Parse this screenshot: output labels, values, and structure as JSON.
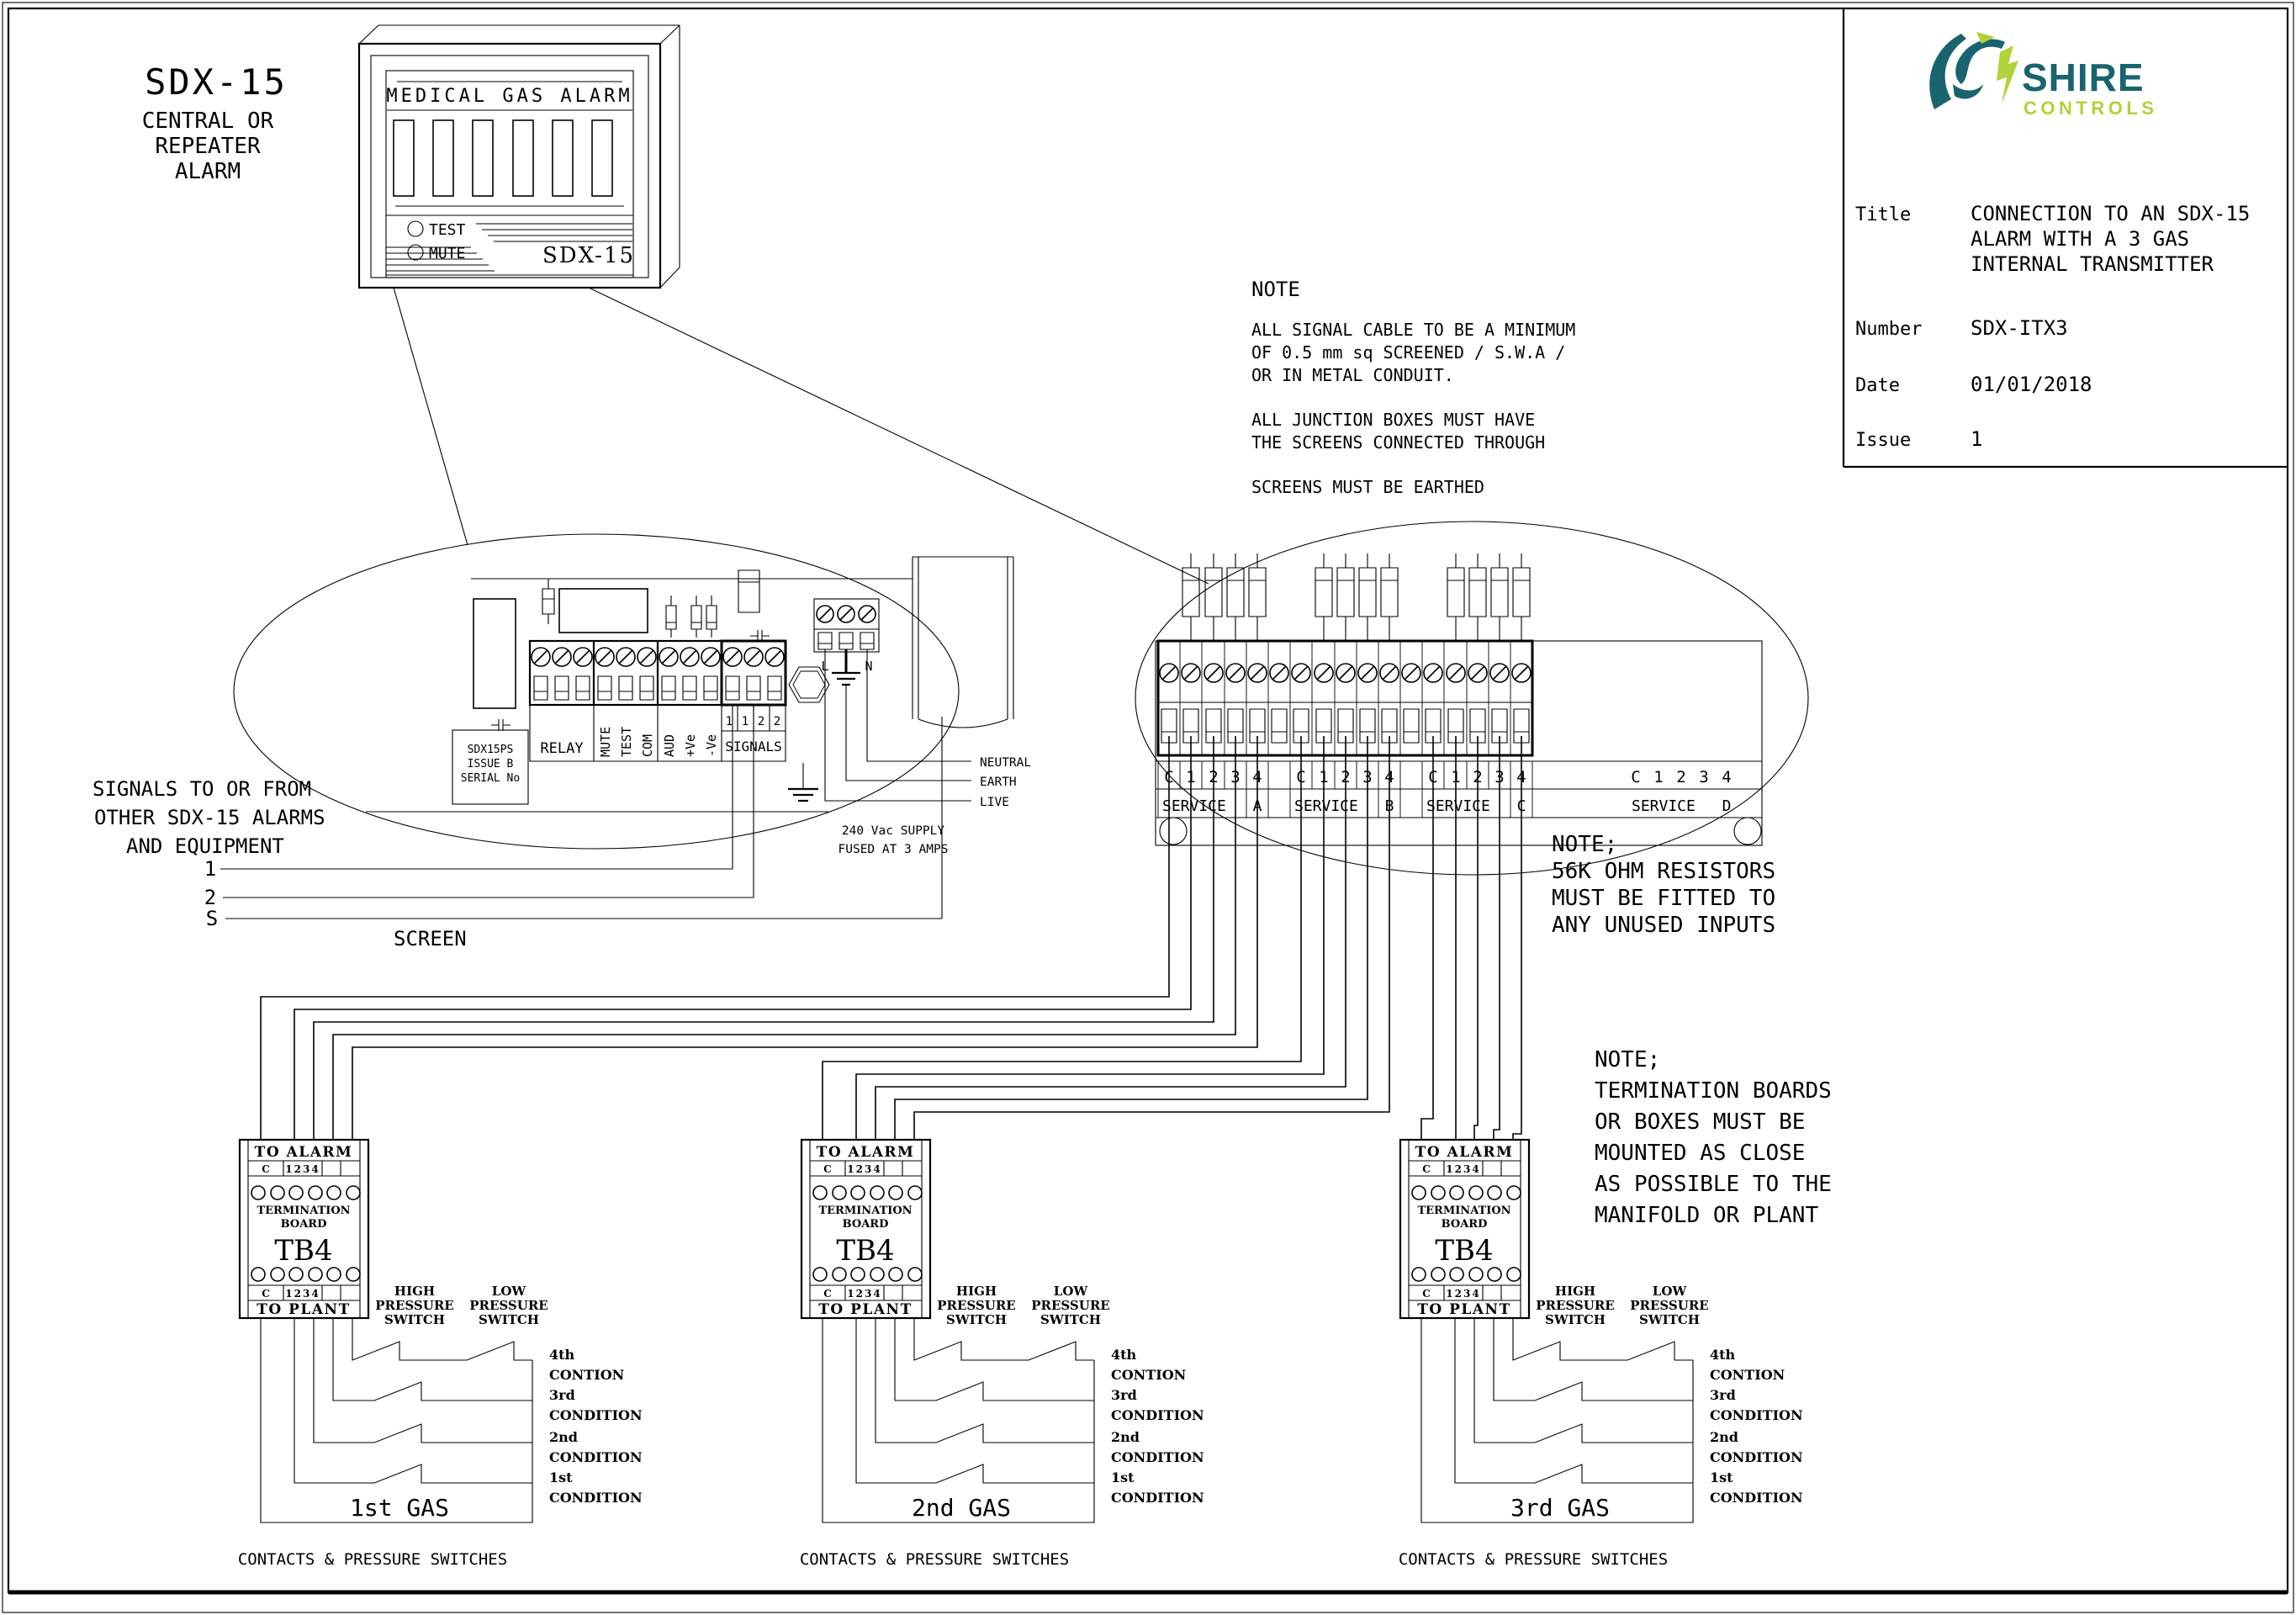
{
  "colors": {
    "ink": "#000000",
    "logo_teal": "#19646f",
    "logo_green": "#b0d23a"
  },
  "heading": {
    "model": "SDX-15",
    "lines": [
      "CENTRAL OR",
      "REPEATER",
      "ALARM"
    ]
  },
  "alarm_panel": {
    "title": "MEDICAL GAS ALARM",
    "test": "TEST",
    "mute": "MUTE",
    "model": "SDX-15"
  },
  "title_block": {
    "brand": [
      "SHIRE",
      "CONTROLS"
    ],
    "title_label": "Title",
    "title_lines": [
      "CONNECTION TO AN SDX-15",
      "ALARM WITH A 3 GAS",
      "INTERNAL TRANSMITTER"
    ],
    "number_label": "Number",
    "number": "SDX-ITX3",
    "date_label": "Date",
    "date": "01/01/2018",
    "issue_label": "Issue",
    "issue": "1"
  },
  "cable_note": {
    "heading": "NOTE",
    "lines": [
      "ALL SIGNAL CABLE TO BE A MINIMUM",
      "OF 0.5 mm sq SCREENED / S.W.A /",
      "OR IN METAL CONDUIT.",
      "ALL JUNCTION BOXES MUST HAVE",
      "THE SCREENS CONNECTED THROUGH",
      "SCREENS MUST BE EARTHED"
    ]
  },
  "left_board": {
    "psu": [
      "SDX15PS",
      "ISSUE B",
      "SERIAL No"
    ],
    "relay": "RELAY",
    "vertical_labels": [
      "MUTE",
      "TEST",
      "COM",
      "AUD",
      "+Ve",
      "-Ve"
    ],
    "signal_cells": [
      "1",
      "1",
      "2",
      "2"
    ],
    "signals": "SIGNALS",
    "live": "L",
    "neutral": "N",
    "wire_labels": [
      "NEUTRAL",
      "EARTH",
      "LIVE"
    ],
    "supply": [
      "240 Vac SUPPLY",
      "FUSED AT 3 AMPS"
    ]
  },
  "signals_note": {
    "lines": [
      "SIGNALS TO OR FROM",
      "OTHER SDX-15 ALARMS",
      "AND EQUIPMENT"
    ],
    "wires": [
      "1",
      "2",
      "S"
    ],
    "screen": "SCREEN"
  },
  "right_board": {
    "services": [
      {
        "cells": [
          "C",
          "1",
          "2",
          "3",
          "4"
        ],
        "name": "SERVICE",
        "letter": "A"
      },
      {
        "cells": [
          "C",
          "1",
          "2",
          "3",
          "4"
        ],
        "name": "SERVICE",
        "letter": "B"
      },
      {
        "cells": [
          "C",
          "1",
          "2",
          "3",
          "4"
        ],
        "name": "SERVICE",
        "letter": "C"
      },
      {
        "cells": [
          "C",
          "1",
          "2",
          "3",
          "4"
        ],
        "name": "SERVICE",
        "letter": "D"
      }
    ]
  },
  "resistor_note": {
    "lines": [
      "NOTE;",
      "56K OHM RESISTORS",
      "MUST BE FITTED TO",
      "ANY UNUSED INPUTS"
    ]
  },
  "mounting_note": {
    "lines": [
      "NOTE;",
      "TERMINATION BOARDS",
      "OR BOXES MUST BE",
      "MOUNTED AS CLOSE",
      "AS POSSIBLE TO THE",
      "MANIFOLD OR PLANT"
    ]
  },
  "gas_blocks": [
    {
      "board": {
        "to_alarm": "TO ALARM",
        "c_top": "C",
        "nums_top": "1234",
        "term1": "TERMINATION",
        "term2": "BOARD",
        "name": "TB4",
        "c_bottom": "C",
        "nums_bottom": "1234",
        "to_plant": "TO PLANT"
      },
      "high": [
        "HIGH",
        "PRESSURE",
        "SWITCH"
      ],
      "low": [
        "LOW",
        "PRESSURE",
        "SWITCH"
      ],
      "conditions": [
        {
          "n": "4th",
          "w": "CONTION"
        },
        {
          "n": "3rd",
          "w": "CONDITION"
        },
        {
          "n": "2nd",
          "w": "CONDITION"
        },
        {
          "n": "1st",
          "w": "CONDITION"
        }
      ],
      "gas": "1st GAS",
      "footer": "CONTACTS & PRESSURE SWITCHES"
    },
    {
      "board": {
        "to_alarm": "TO ALARM",
        "c_top": "C",
        "nums_top": "1234",
        "term1": "TERMINATION",
        "term2": "BOARD",
        "name": "TB4",
        "c_bottom": "C",
        "nums_bottom": "1234",
        "to_plant": "TO PLANT"
      },
      "high": [
        "HIGH",
        "PRESSURE",
        "SWITCH"
      ],
      "low": [
        "LOW",
        "PRESSURE",
        "SWITCH"
      ],
      "conditions": [
        {
          "n": "4th",
          "w": "CONTION"
        },
        {
          "n": "3rd",
          "w": "CONDITION"
        },
        {
          "n": "2nd",
          "w": "CONDITION"
        },
        {
          "n": "1st",
          "w": "CONDITION"
        }
      ],
      "gas": "2nd GAS",
      "footer": "CONTACTS & PRESSURE SWITCHES"
    },
    {
      "board": {
        "to_alarm": "TO ALARM",
        "c_top": "C",
        "nums_top": "1234",
        "term1": "TERMINATION",
        "term2": "BOARD",
        "name": "TB4",
        "c_bottom": "C",
        "nums_bottom": "1234",
        "to_plant": "TO PLANT"
      },
      "high": [
        "HIGH",
        "PRESSURE",
        "SWITCH"
      ],
      "low": [
        "LOW",
        "PRESSURE",
        "SWITCH"
      ],
      "conditions": [
        {
          "n": "4th",
          "w": "CONTION"
        },
        {
          "n": "3rd",
          "w": "CONDITION"
        },
        {
          "n": "2nd",
          "w": "CONDITION"
        },
        {
          "n": "1st",
          "w": "CONDITION"
        }
      ],
      "gas": "3rd GAS",
      "footer": "CONTACTS & PRESSURE SWITCHES"
    }
  ]
}
